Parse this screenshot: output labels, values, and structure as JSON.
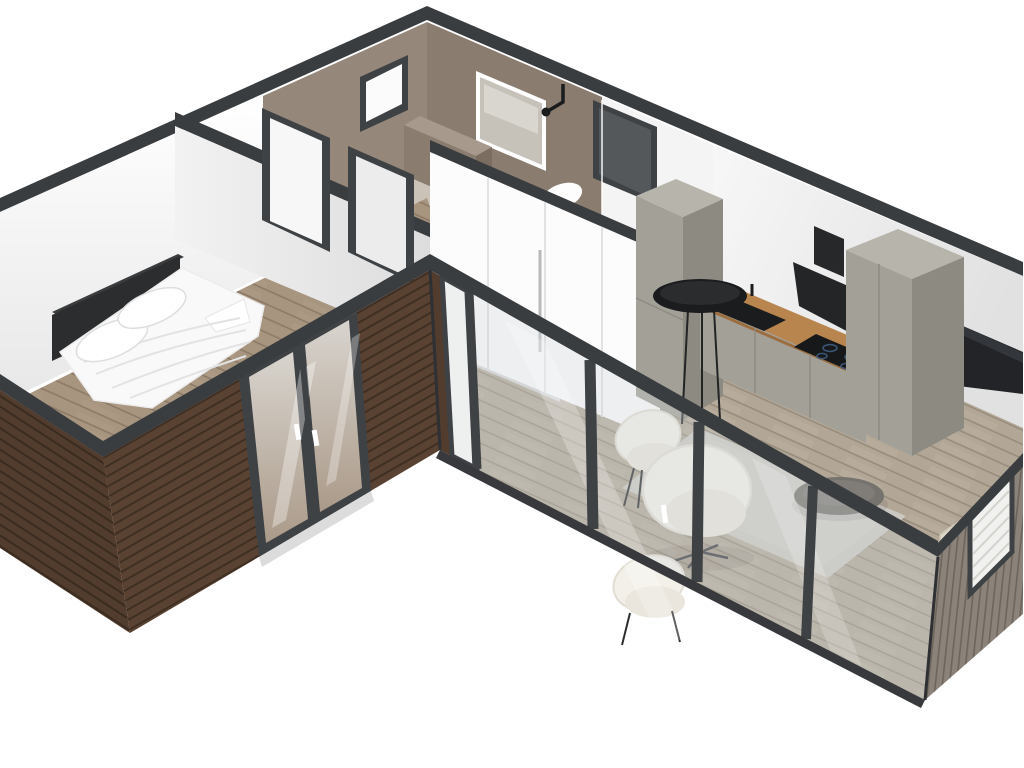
{
  "scene": {
    "type": "isometric-3d-floorplan-cutaway-render",
    "building_shape": "L-shaped single-storey modular home",
    "view": "bird's-eye axonometric from south-east",
    "background": "#ffffff"
  },
  "colors": {
    "bg": "#ffffff",
    "cap": "#3a3d40",
    "capDark": "#2e3033",
    "frame": "#3f4245",
    "frameInner": "#55585b",
    "wallWhiteA": "#ffffff",
    "wallWhiteB": "#e7e7e7",
    "wallGray": "#d7d8d9",
    "taupeWall": "#95887a",
    "taupeWallDark": "#8a7c6e",
    "taupeFloor": "#cbc3b8",
    "taupeBox": "#8a7d6f",
    "taupeBoxTop": "#a79a8c",
    "taupeBoxSide": "#7b6e61",
    "wood": "#5a4232",
    "woodGap": "#3f2f23",
    "woodB": "#523c2d",
    "woodGapB": "#3a2b20",
    "gable": "#8b8379",
    "gableGap": "#6d655b",
    "floorBed": "#a8957f",
    "floorBedLine": "#8d7a67",
    "floorLiv": "#b2a796",
    "floorLivLine": "#988d7c",
    "counter": "#b9854f",
    "counterEdge": "#9c6e3f",
    "cabinetFront": "#a3a098",
    "cabinetSide": "#8d8a81",
    "cabinetTop": "#b7b4ab",
    "black": "#1b1c1e",
    "tv": "#222427",
    "hob": "#17181a",
    "hobRing": "#3a5574",
    "bedWhite": "#f9f9f9",
    "bedShadow": "#e9e9e9",
    "headboard": "#2b2d2f",
    "chair": "#f3f0ea",
    "chairSeat": "#eae6dd",
    "rug": "#cbc8c2",
    "chaise": "#ddd7ca",
    "glassTint": "rgba(206,214,217,0.33)",
    "doorGlassA": "#ab9a89",
    "doorGlassB": "#d8d4ce",
    "mirror": "#c6c1b9",
    "white": "#fdfdfd"
  },
  "rooms": [
    {
      "name": "bedroom",
      "wing": "west",
      "items": [
        "double-bed",
        "dark-headboard",
        "pillow",
        "pillow",
        "white-duvet",
        "french-double-door"
      ]
    },
    {
      "name": "bathroom",
      "wing": "west-rear",
      "items": [
        "led-mirror",
        "shower-fixture",
        "vanity-cabinet",
        "toilet",
        "small-window"
      ]
    },
    {
      "name": "hallway",
      "wing": "west-mid",
      "items": [
        "doorway",
        "doorway",
        "entry-door"
      ]
    },
    {
      "name": "kitchen",
      "wing": "east-rear",
      "items": [
        "tall-cabinet-left",
        "tall-cabinet-right",
        "white-cabinet-run",
        "wood-countertop",
        "black-sink",
        "induction-hob",
        "range-hood",
        "round-bar-table"
      ]
    },
    {
      "name": "living-room",
      "wing": "east",
      "items": [
        "wall-tv",
        "area-rug",
        "round-coffee-table",
        "swivel-armchair",
        "dining-chair",
        "dining-chair",
        "chaise",
        "glazed-facade",
        "gable-window-with-blinds"
      ]
    }
  ],
  "exterior": {
    "siding_front": "horizontal-dark-wood-slats",
    "siding_gable": "vertical-gray-wood-slats",
    "wall_tops": "dark-gray-cut-caps",
    "openings": [
      "bedroom-french-doors",
      "narrow-corner-window",
      "glazed-door",
      "fixed-glass-panes",
      "gable-window"
    ]
  }
}
